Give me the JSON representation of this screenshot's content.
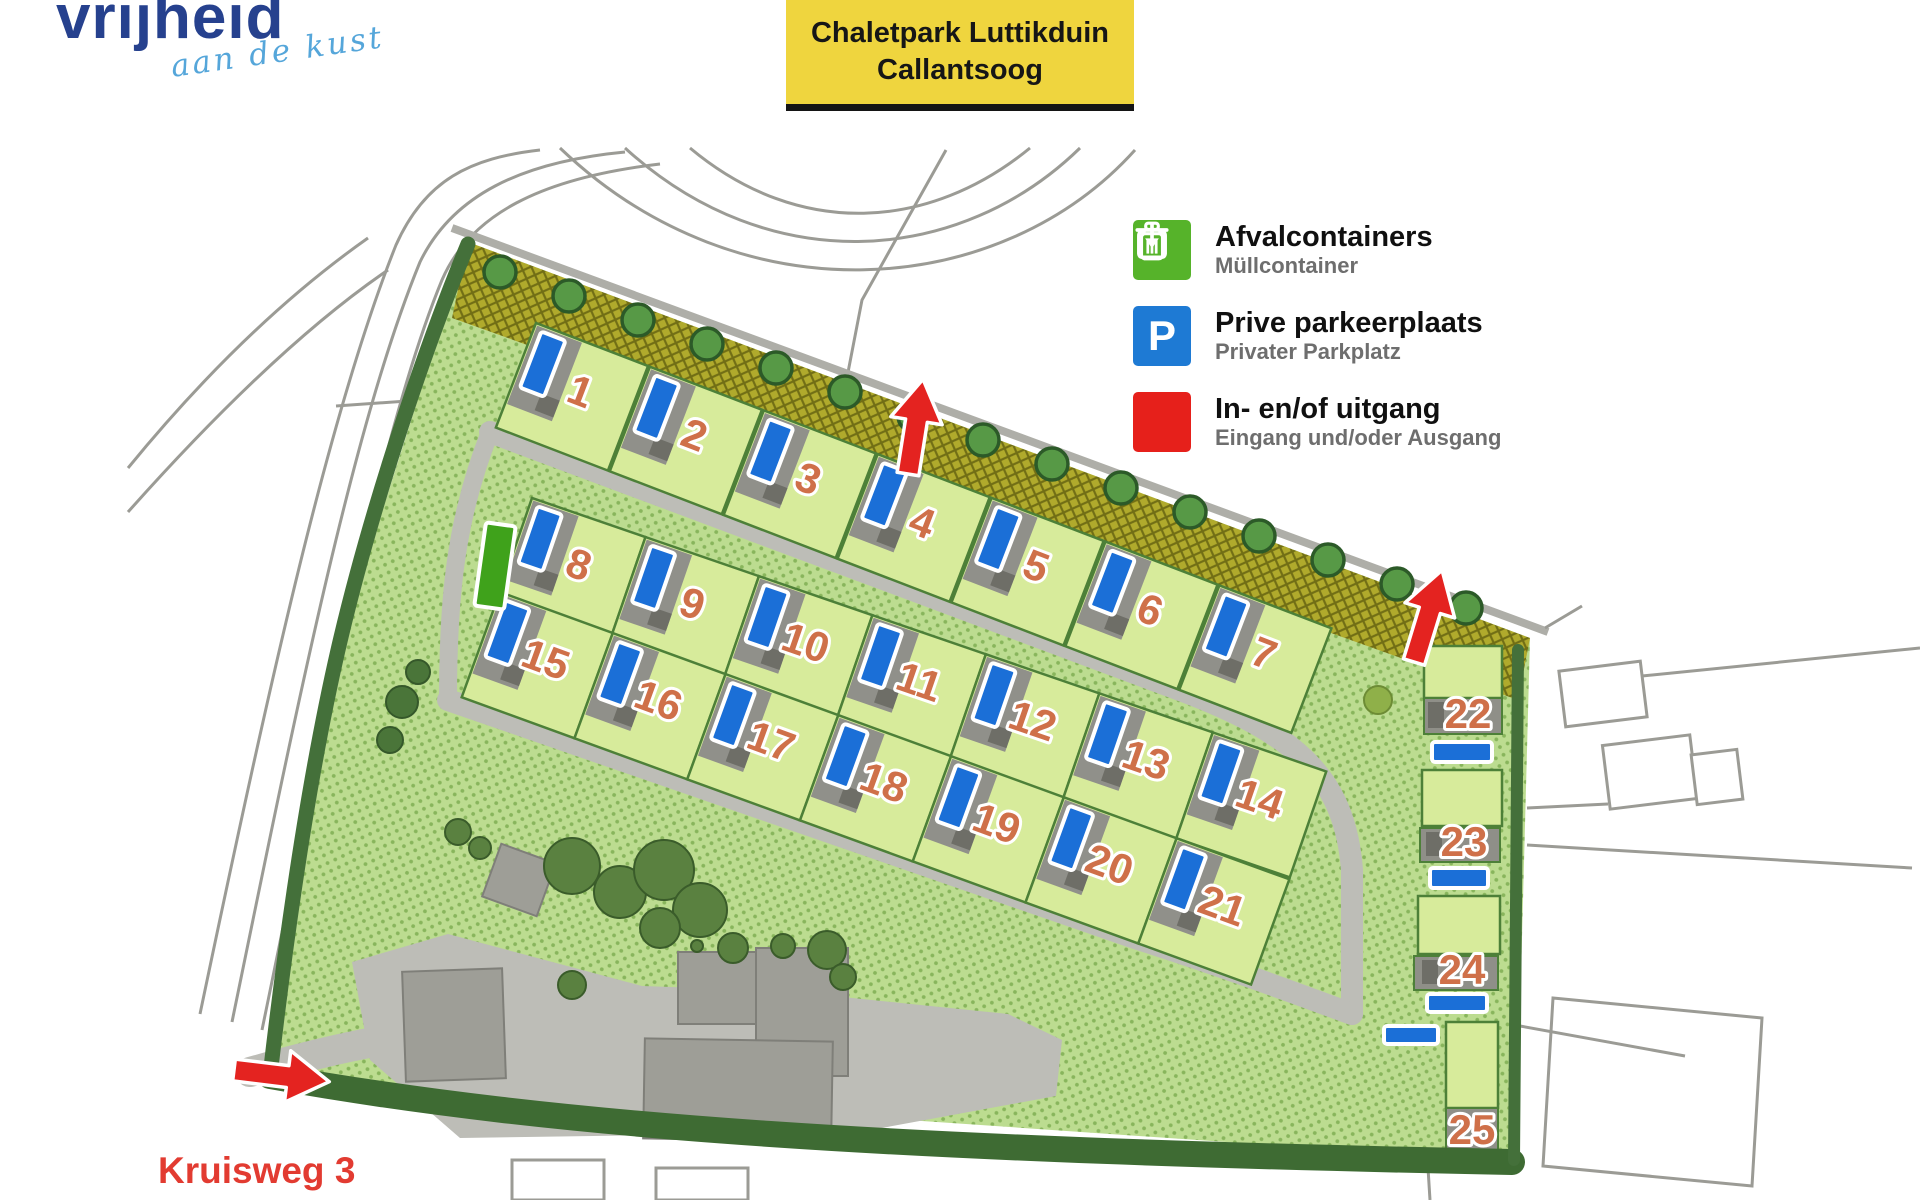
{
  "logo": {
    "name": "vrijheid",
    "tagline": "aan de kust"
  },
  "title_box": {
    "line1": "Chaletpark Luttikduin",
    "line2": "Callantsoog"
  },
  "legend": {
    "items": [
      {
        "icon": "trash-icon",
        "color": "#56b32a",
        "label": "Afvalcontainers",
        "sublabel": "Müllcontainer"
      },
      {
        "icon": "parking-icon",
        "color": "#1e7ad4",
        "label": "Prive parkeerplaats",
        "sublabel": "Privater Parkplatz",
        "symbol": "P"
      },
      {
        "icon": "entrance-icon",
        "color": "#e6201b",
        "label": "In- en/of uitgang",
        "sublabel": "Eingang und/oder Ausgang"
      }
    ]
  },
  "map": {
    "street_label": "Kruisweg 3",
    "plots": [
      "1",
      "2",
      "3",
      "4",
      "5",
      "6",
      "7",
      "8",
      "9",
      "10",
      "11",
      "12",
      "13",
      "14",
      "15",
      "16",
      "17",
      "18",
      "19",
      "20",
      "21",
      "22",
      "23",
      "24",
      "25"
    ]
  },
  "colors": {
    "title_yellow": "#efd53e",
    "logo_blue": "#26418e",
    "logo_light_blue": "#55a6da",
    "plot_green": "#d7eb9b",
    "lawn_green": "#bcdc90",
    "hedge_green": "#44703a",
    "band_olive": "#b0aa2c",
    "road_gray": "#bdbdb7",
    "parking_blue": "#1b6fd7",
    "container_green": "#3fa21b",
    "number_salmon": "#cf7049",
    "arrow_red": "#e42320",
    "street_red": "#e23b31"
  }
}
